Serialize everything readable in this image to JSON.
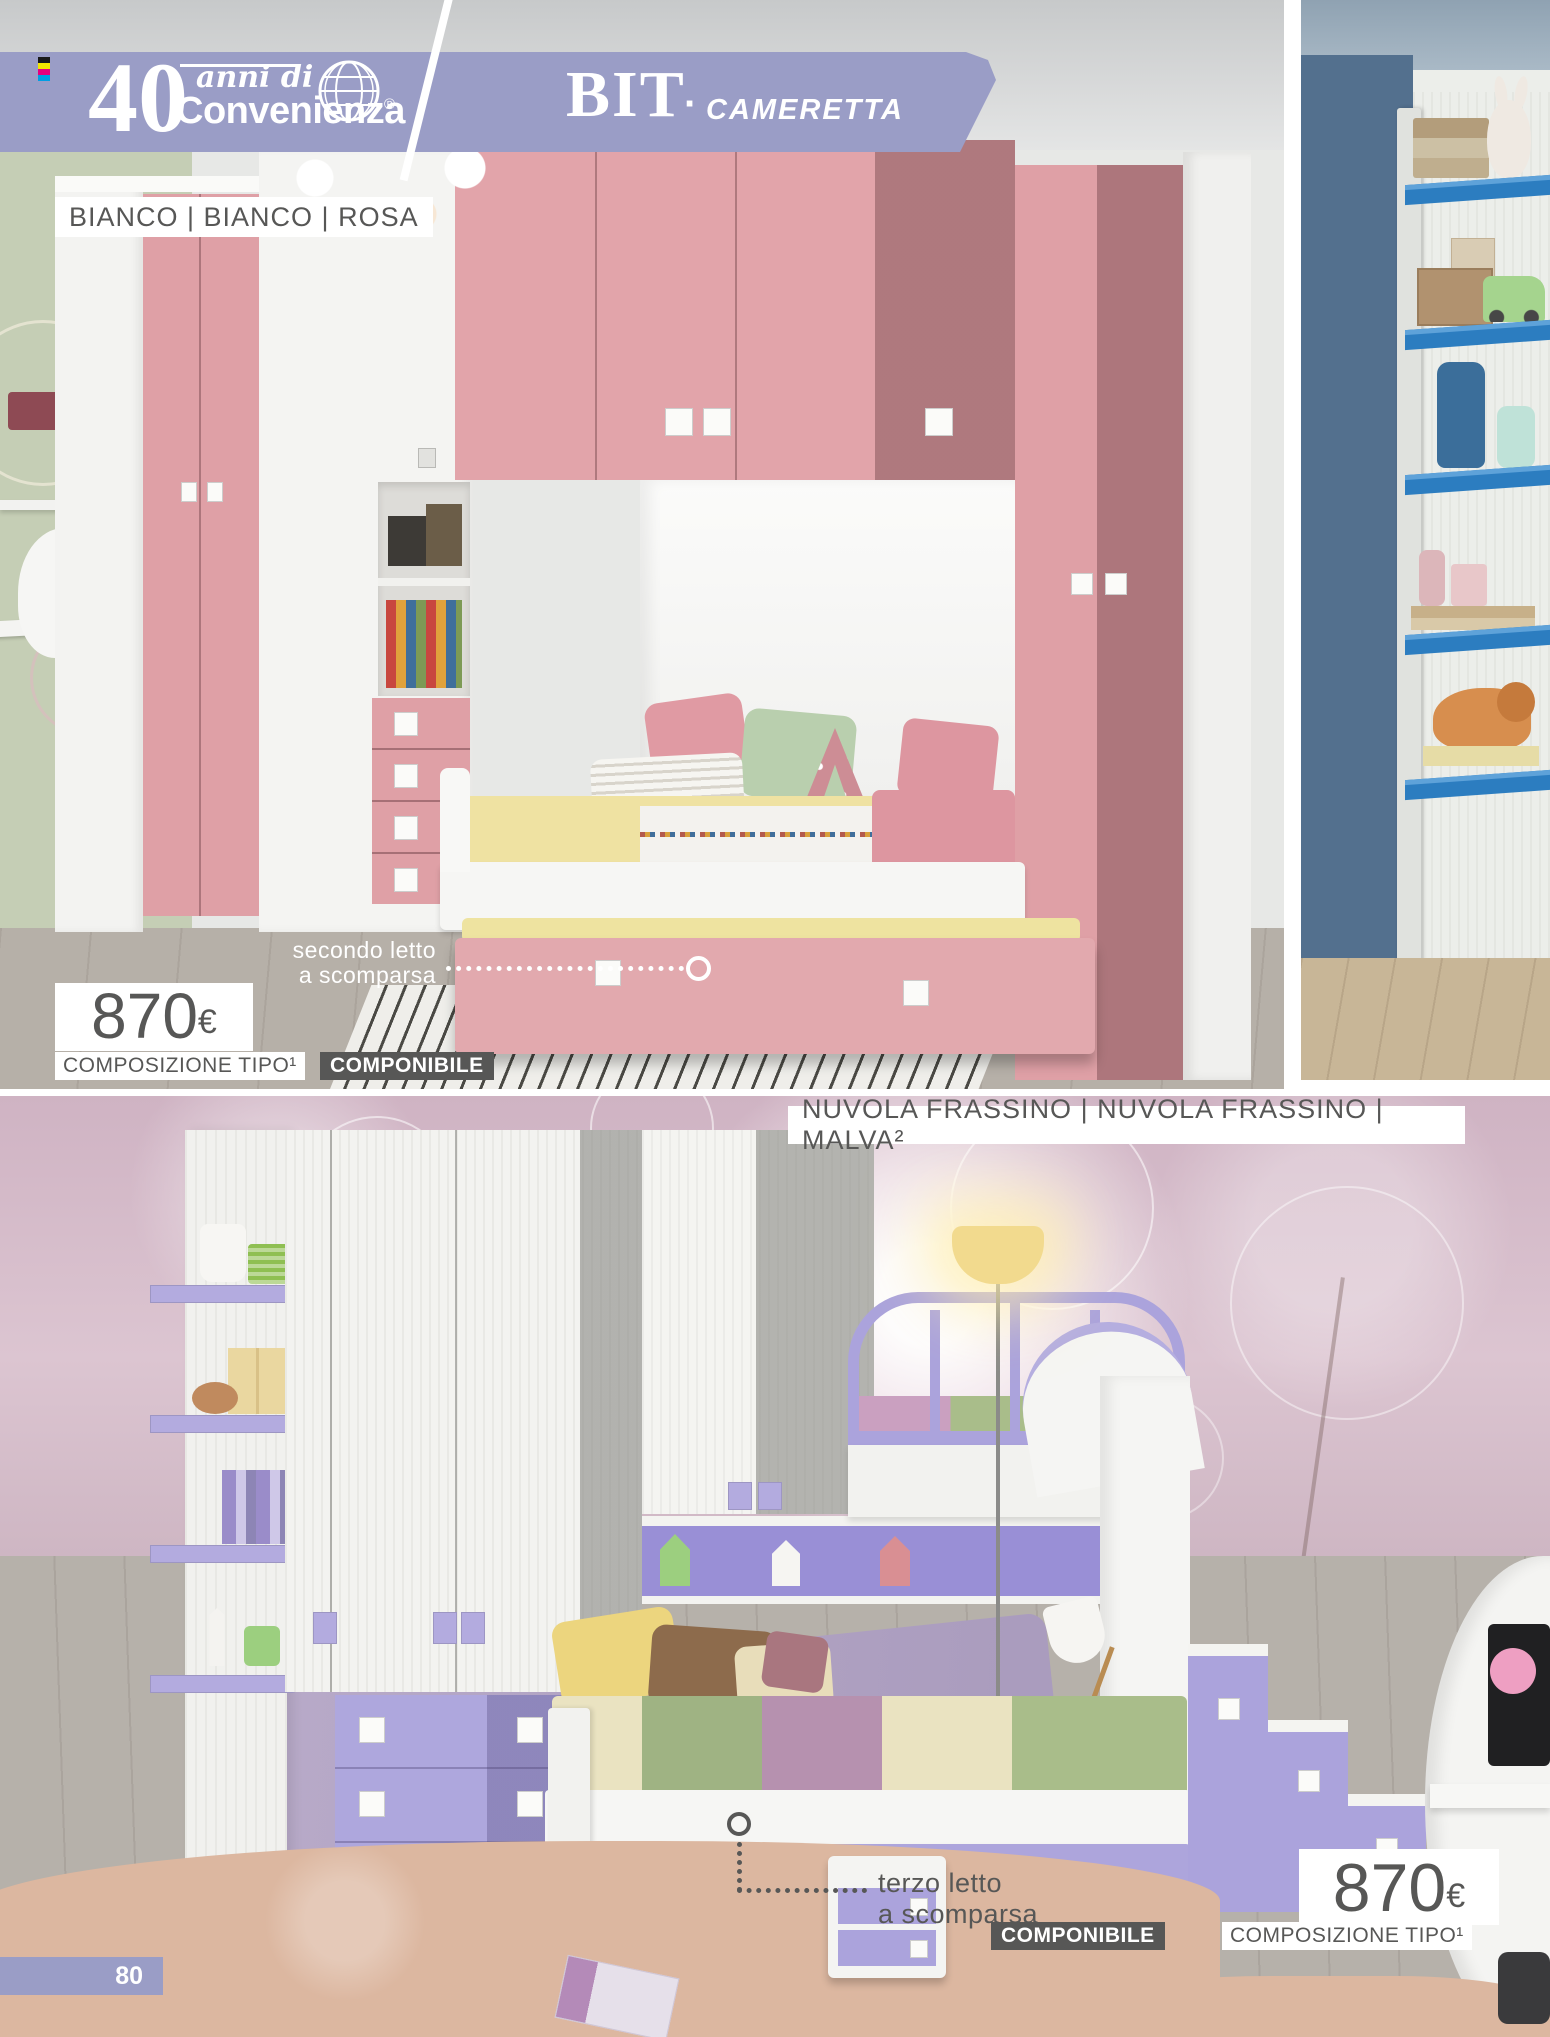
{
  "header": {
    "brand": {
      "number": "40",
      "tagline": "anni di",
      "name": "Convenienza",
      "registered": "®"
    },
    "collection": "BIT",
    "separator": "·",
    "category": "CAMERETTA",
    "band_color": "#9a9dc6"
  },
  "top_section": {
    "finish_label": "BIANCO | BIANCO | ROSA",
    "callout": {
      "line1": "secondo letto",
      "line2": "a scomparsa"
    },
    "price": {
      "amount": "870",
      "currency": "€"
    },
    "composition_note": "COMPOSIZIONE TIPO¹",
    "badge": "COMPONIBILE"
  },
  "bottom_section": {
    "finish_label": "NUVOLA FRASSINO | NUVOLA FRASSINO | MALVA²",
    "callout": {
      "line1": "terzo letto",
      "line2": "a scomparsa"
    },
    "badge": "COMPONIBILE",
    "composition_note": "COMPOSIZIONE TIPO¹",
    "price": {
      "amount": "870",
      "currency": "€"
    }
  },
  "page": {
    "number": "80"
  },
  "icons": {
    "globe": "wire-globe",
    "registration_mark": "cmyk-bars"
  },
  "colors": {
    "header_band": "#9a9dc6",
    "furniture_pink": "#dfa0a6",
    "furniture_lilac": "#aea7dd",
    "shelf_blue": "#2e7fc2",
    "badge_dark": "#575756",
    "text_gray": "#575756"
  }
}
